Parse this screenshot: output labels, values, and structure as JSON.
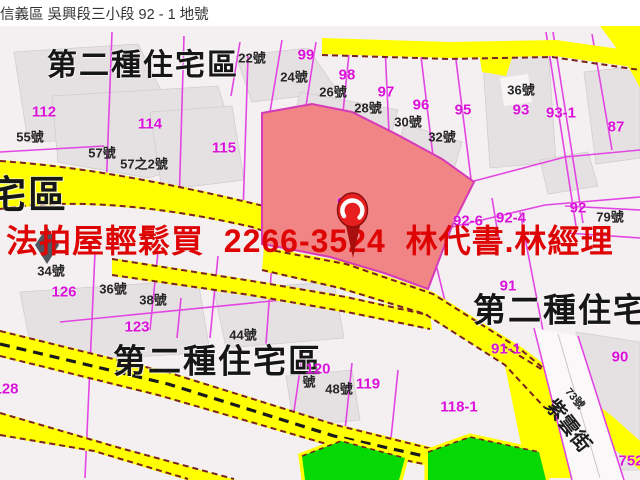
{
  "title": "信義區 吳興段三小段 92 - 1 地號",
  "banner": {
    "text": "法拍屋輕鬆買  2266-3524  林代書.林經理",
    "color": "#de0404"
  },
  "colors": {
    "highlight_parcel": "#f18585",
    "road_yellow": "#ffff00",
    "park_green": "#04d904",
    "parcel_line_magenta": "#e23de2",
    "zone_text_black": "#161616",
    "banner_red": "#de0404"
  },
  "map": {
    "subject_parcel": "92-1",
    "zone_labels": [
      {
        "t": "第二種住宅區",
        "x": 143,
        "y": 66,
        "size": 30
      },
      {
        "t": "宅區",
        "x": 28,
        "y": 196,
        "size": 38
      },
      {
        "t": "第二種住宅區",
        "x": 218,
        "y": 361,
        "size": 33
      },
      {
        "t": "第二種住宅區",
        "x": 578,
        "y": 310,
        "size": 33
      }
    ],
    "parcel_numbers": [
      {
        "t": "99",
        "x": 306,
        "y": 55
      },
      {
        "t": "98",
        "x": 347,
        "y": 75
      },
      {
        "t": "97",
        "x": 386,
        "y": 92
      },
      {
        "t": "96",
        "x": 421,
        "y": 105
      },
      {
        "t": "95",
        "x": 463,
        "y": 110
      },
      {
        "t": "93",
        "x": 521,
        "y": 110
      },
      {
        "t": "93-1",
        "x": 561,
        "y": 113
      },
      {
        "t": "87",
        "x": 616,
        "y": 127
      },
      {
        "t": "112",
        "x": 44,
        "y": 112
      },
      {
        "t": "114",
        "x": 150,
        "y": 124
      },
      {
        "t": "115",
        "x": 224,
        "y": 148
      },
      {
        "t": "92-1",
        "x": 352,
        "y": 203
      },
      {
        "t": "92-6",
        "x": 468,
        "y": 221
      },
      {
        "t": "92-4",
        "x": 511,
        "y": 218
      },
      {
        "t": "92",
        "x": 578,
        "y": 208
      },
      {
        "t": "91",
        "x": 508,
        "y": 286
      },
      {
        "t": "91-1",
        "x": 506,
        "y": 349
      },
      {
        "t": "90",
        "x": 620,
        "y": 357
      },
      {
        "t": "128",
        "x": 6,
        "y": 389
      },
      {
        "t": "126",
        "x": 64,
        "y": 292
      },
      {
        "t": "123",
        "x": 137,
        "y": 327
      },
      {
        "t": "120",
        "x": 318,
        "y": 369
      },
      {
        "t": "119",
        "x": 368,
        "y": 384
      },
      {
        "t": "118-1",
        "x": 459,
        "y": 407
      },
      {
        "t": "752",
        "x": 631,
        "y": 461
      }
    ],
    "house_numbers": [
      {
        "t": "22號",
        "x": 252,
        "y": 58
      },
      {
        "t": "24號",
        "x": 294,
        "y": 77
      },
      {
        "t": "26號",
        "x": 333,
        "y": 92
      },
      {
        "t": "28號",
        "x": 368,
        "y": 108
      },
      {
        "t": "30號",
        "x": 408,
        "y": 122
      },
      {
        "t": "32號",
        "x": 442,
        "y": 137
      },
      {
        "t": "36號",
        "x": 521,
        "y": 90
      },
      {
        "t": "55號",
        "x": 30,
        "y": 137
      },
      {
        "t": "57號",
        "x": 102,
        "y": 153
      },
      {
        "t": "57之2號",
        "x": 144,
        "y": 164
      },
      {
        "t": "34號",
        "x": 51,
        "y": 271
      },
      {
        "t": "36號",
        "x": 113,
        "y": 289
      },
      {
        "t": "38號",
        "x": 153,
        "y": 300
      },
      {
        "t": "44號",
        "x": 243,
        "y": 335
      },
      {
        "t": "號",
        "x": 309,
        "y": 382
      },
      {
        "t": "48號",
        "x": 339,
        "y": 389
      },
      {
        "t": "79號",
        "x": 610,
        "y": 217
      },
      {
        "t": "73號",
        "x": 574,
        "y": 399,
        "r": 50,
        "size": 11
      }
    ],
    "street_names": [
      {
        "t": "紫雲街",
        "x": 568,
        "y": 426,
        "r": 52,
        "size": 20
      }
    ]
  }
}
